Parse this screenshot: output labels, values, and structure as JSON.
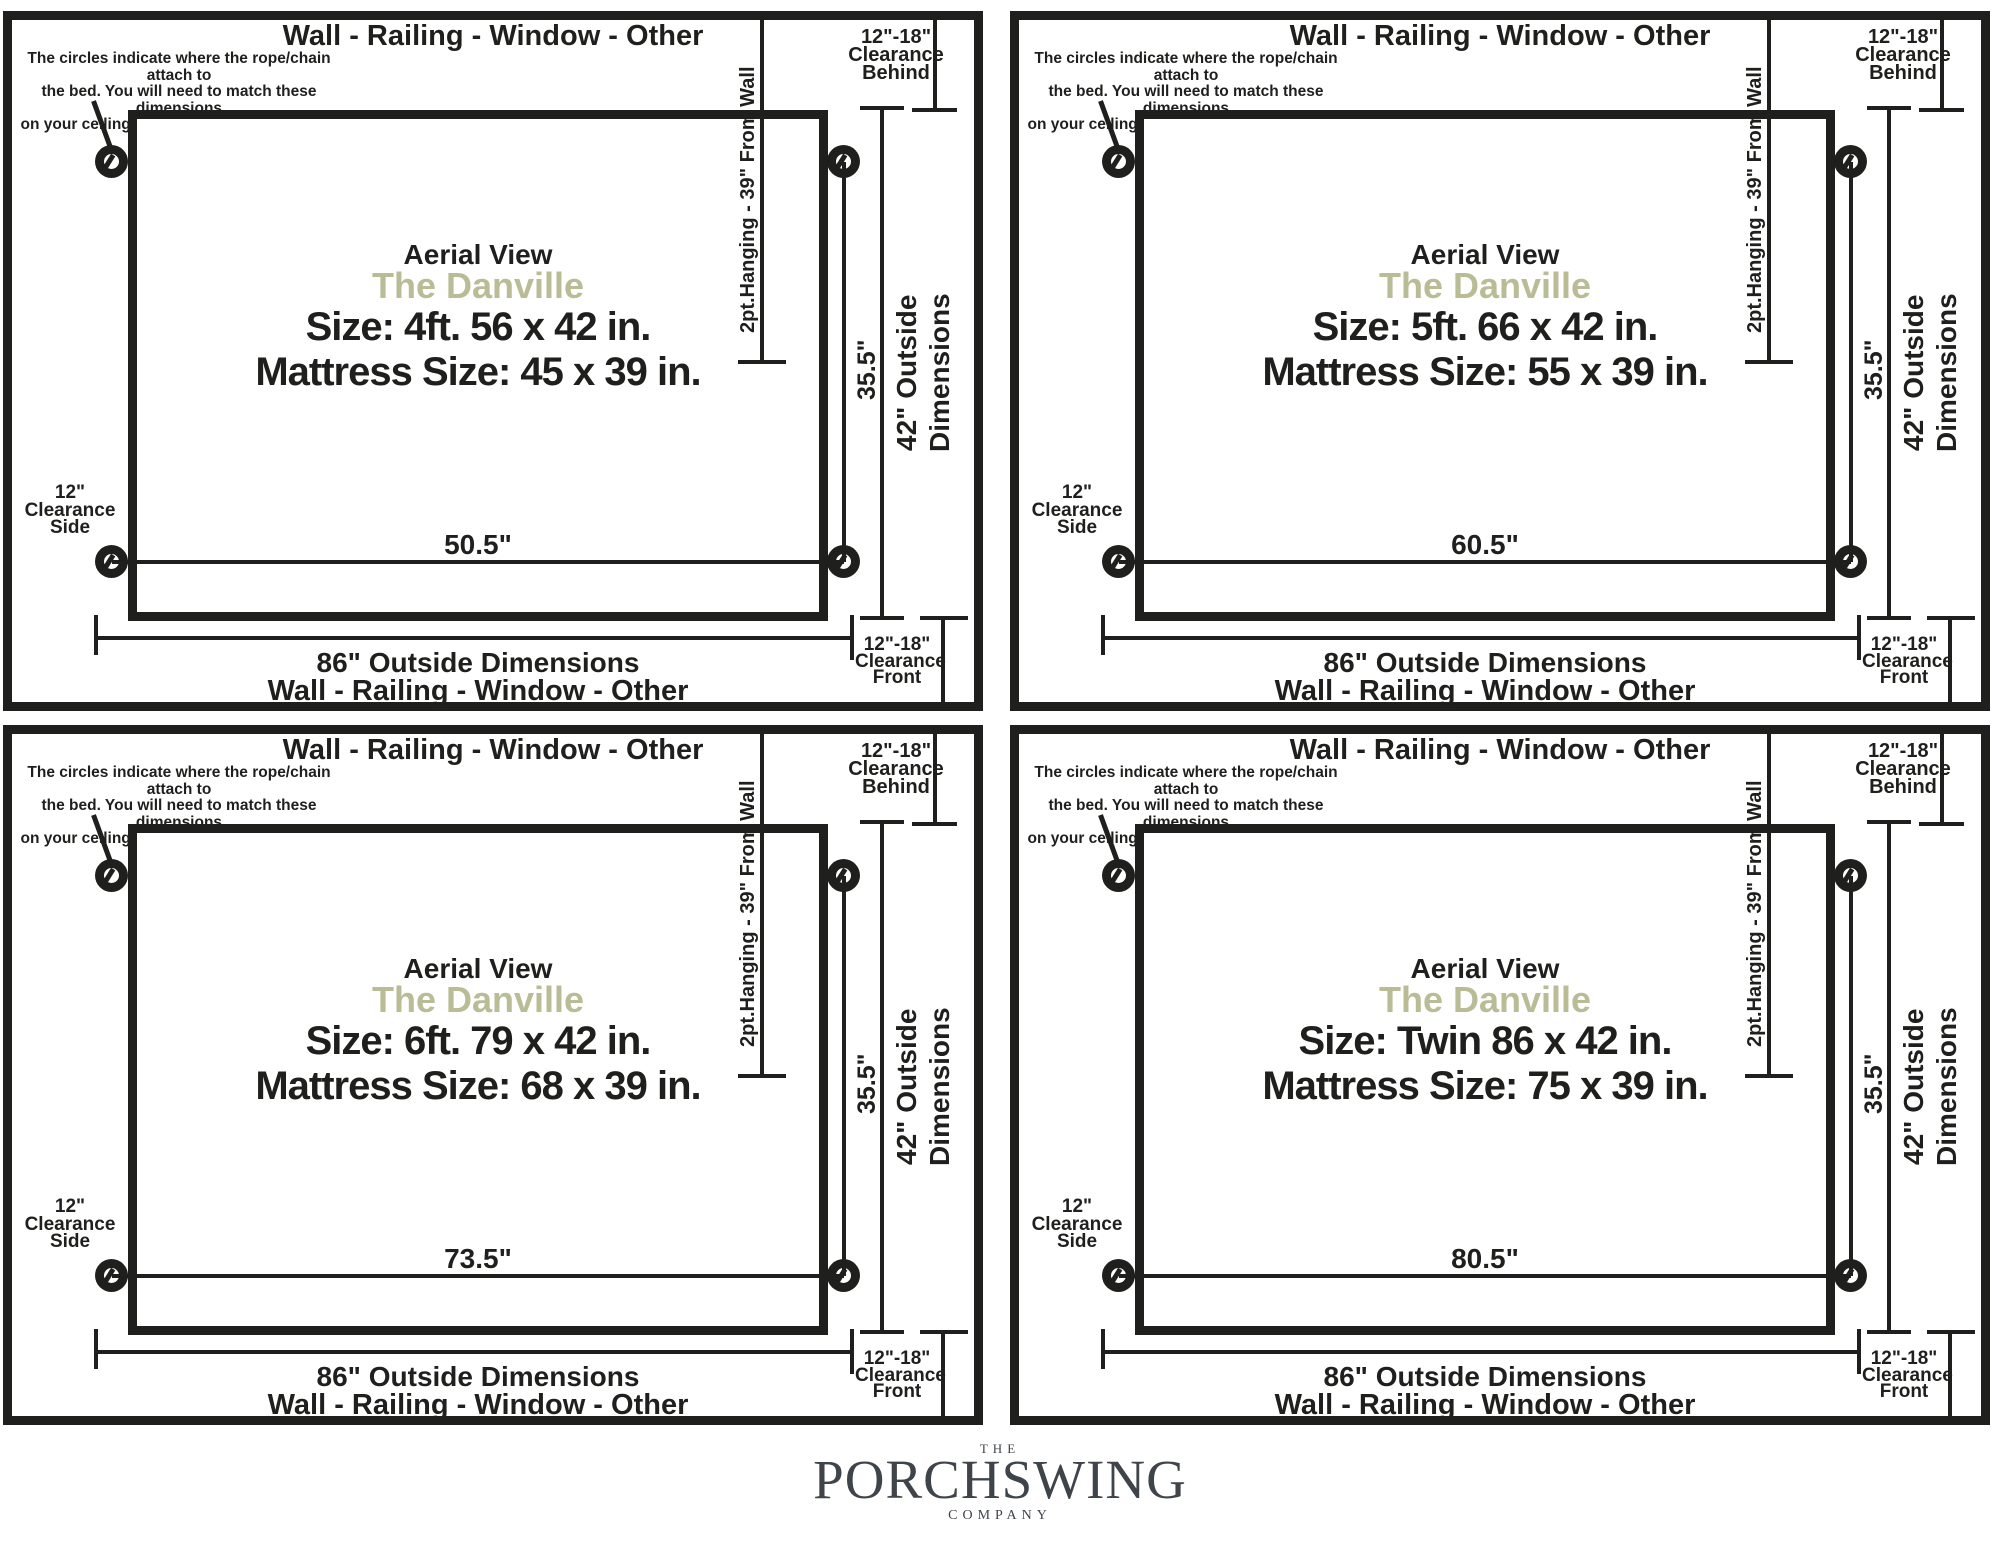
{
  "shared": {
    "boundary_label": "Wall - Railing - Window - Other",
    "note_lines": [
      "The circles indicate where the rope/chain attach to",
      "the bed. You will need to match these dimensions",
      "on your ceiling and into support beam with hooks."
    ],
    "aerial_label": "Aerial View",
    "product_name": "The Danville",
    "hanging_label": "2pt.Hanging - 39\" From Wall",
    "attach_span_label": "35.5\"",
    "outside_height_line1": "42\" Outside",
    "outside_height_line2": "Dimensions",
    "outside_width_label": "86\" Outside Dimensions",
    "clearance_side_lines": [
      "12\"",
      "Clearance",
      "Side"
    ],
    "clearance_behind_lines": [
      "12\"-18\"",
      "Clearance",
      "Behind"
    ],
    "clearance_front_lines": [
      "12\"-18\"",
      "Clearance",
      "Front"
    ]
  },
  "panels": [
    {
      "id": "4ft",
      "size_label": "Size: 4ft. 56 x 42 in.",
      "mattress_label": "Mattress Size: 45 x 39 in.",
      "width_label": "50.5\""
    },
    {
      "id": "5ft",
      "size_label": "Size: 5ft. 66 x 42 in.",
      "mattress_label": "Mattress Size: 55 x 39 in.",
      "width_label": "60.5\""
    },
    {
      "id": "6ft",
      "size_label": "Size: 6ft. 79 x 42 in.",
      "mattress_label": "Mattress Size: 68 x 39 in.",
      "width_label": "73.5\""
    },
    {
      "id": "twin",
      "size_label": "Size: Twin 86 x 42 in.",
      "mattress_label": "Mattress Size: 75 x 39 in.",
      "width_label": "80.5\""
    }
  ],
  "logo": {
    "prefix": "THE",
    "name": "PORCHSWING",
    "suffix": "COMPANY"
  },
  "colors": {
    "ink": "#1f1f1d",
    "product_name_accent": "#b9bc95",
    "logo_gray": "#3e444a"
  }
}
